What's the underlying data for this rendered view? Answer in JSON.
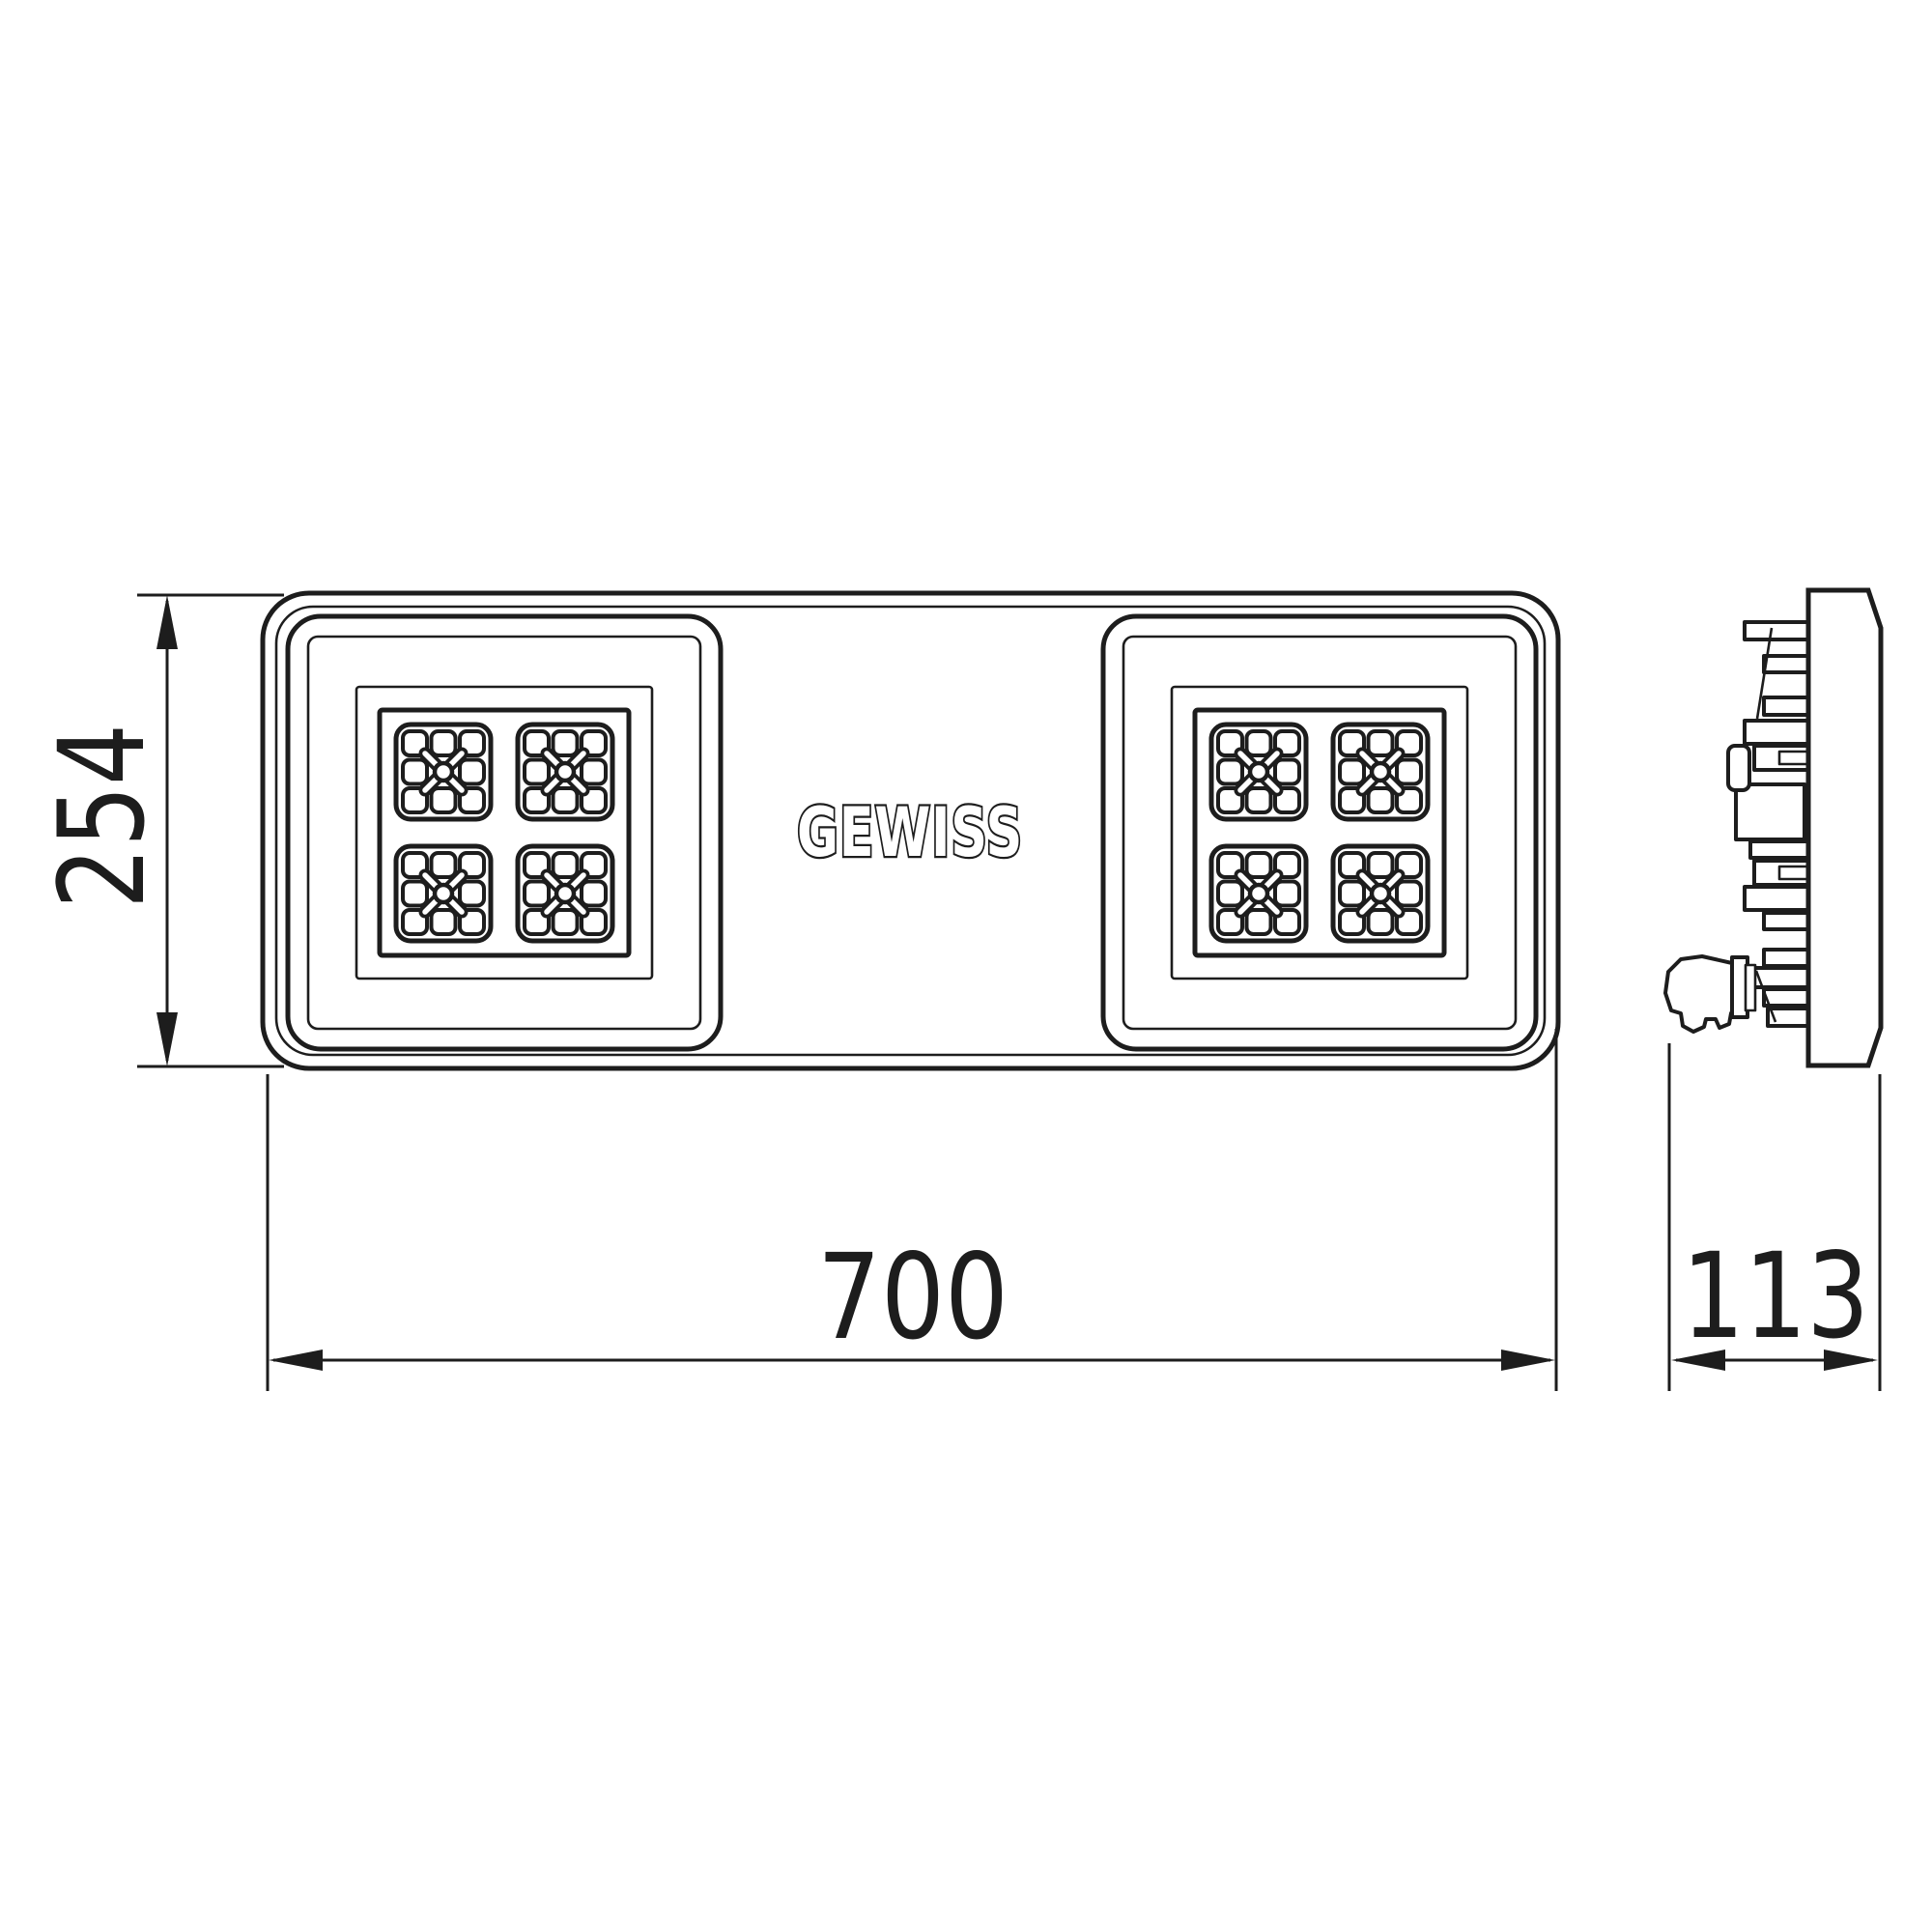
{
  "drawing": {
    "brand_logo": "GEWISS",
    "dimension_height": "254",
    "dimension_width": "700",
    "dimension_depth": "113",
    "line_color": "#1d1d1d",
    "background_color": "#ffffff"
  }
}
